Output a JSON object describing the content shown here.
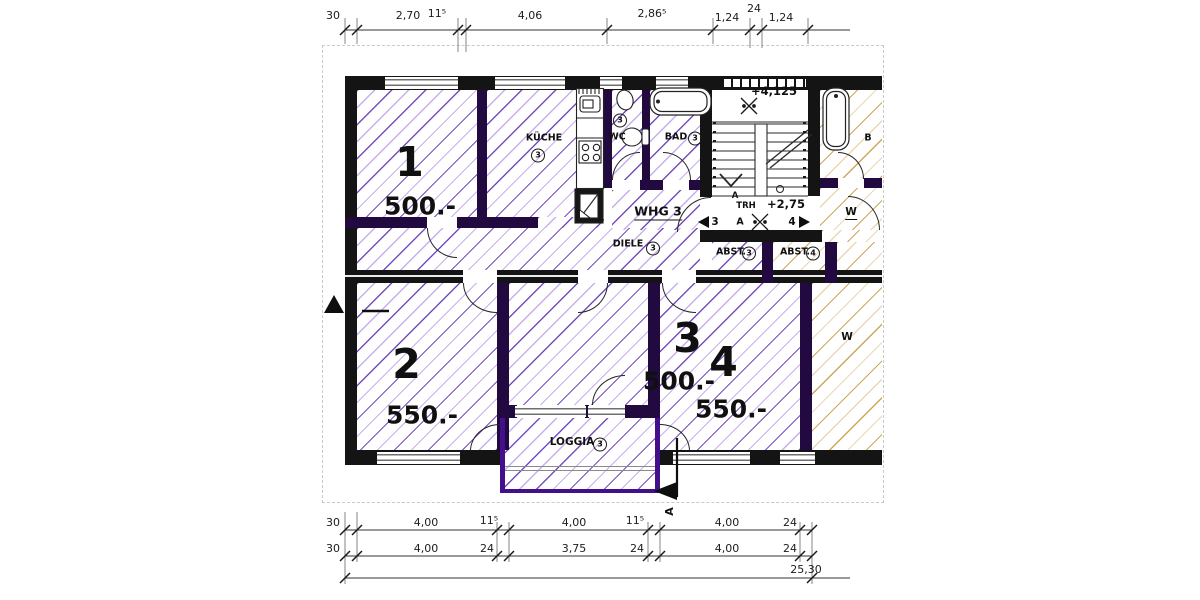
{
  "drawing": "apartment-floor-plan",
  "colors": {
    "hatch_apartment3": "#6c3eba",
    "hatch_apartment4": "#c69a3e",
    "walls": "#141414",
    "inner_walls": "#220a40",
    "loggia_wall": "#430f8a"
  },
  "dims": {
    "top": [
      "30",
      "2,70",
      "11⁵",
      "4,06",
      "2,86⁵",
      "1,24",
      "24",
      "1,24"
    ],
    "row1": [
      "30",
      "4,00",
      "11⁵",
      "4,00",
      "11⁵",
      "4,00",
      "24"
    ],
    "row2": [
      "30",
      "4,00",
      "24",
      "3,75",
      "24",
      "4,00",
      "24"
    ],
    "total": "25,30"
  },
  "rooms": {
    "r1": {
      "number": "1",
      "price": "500.-"
    },
    "r2": {
      "number": "2",
      "price": "550.-"
    },
    "r3": {
      "number": "3",
      "price": "500.-"
    },
    "r4": {
      "number": "4",
      "price": "550.-"
    }
  },
  "labels": {
    "kueche": "KÜCHE",
    "kueche_num": "3",
    "wc": "WC",
    "wc_num": "3",
    "bad": "BAD",
    "bad_num": "3",
    "whg": "WHG 3",
    "diele": "DIELE",
    "diele_num": "3",
    "abst3": "ABST.",
    "abst3_num": "3",
    "abst4": "ABST.",
    "abst4_num": "4",
    "loggia": "LOGGIA",
    "loggia_num": "3",
    "trh": "TRH",
    "a_small": "A",
    "a_mid": "A",
    "a_section": "A",
    "lvl_up": "+4,125",
    "lvl_down": "+2,75",
    "stair_from": "3",
    "stair_to": "4",
    "cut_b": "B",
    "cut_w": "W",
    "cut_w2": "W"
  }
}
